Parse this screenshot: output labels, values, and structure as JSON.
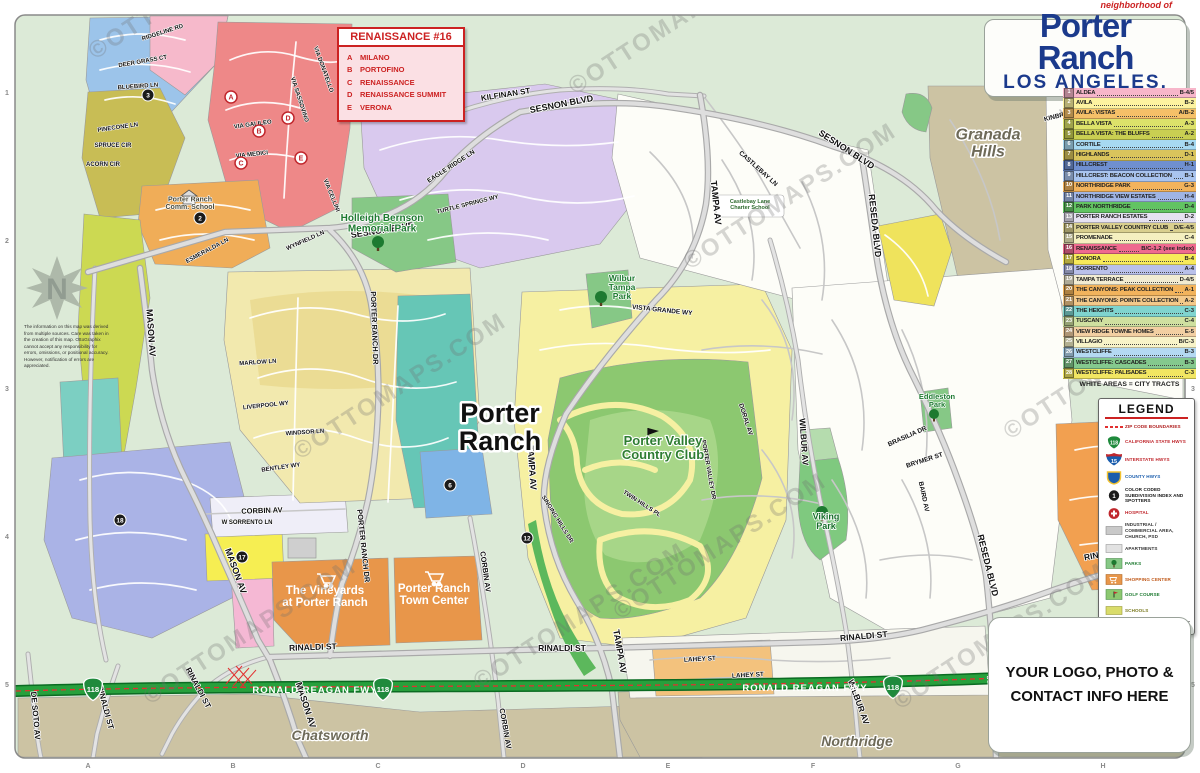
{
  "title_card": {
    "neighborhood_of": "neighborhood of",
    "title": "Porter Ranch",
    "subtitle": "LOS ANGELES, CA"
  },
  "watermark": {
    "text": "©OTTOMAPS.COM"
  },
  "accent_colors": {
    "freeway_green": "#27a03c",
    "zip_red": "#e23030",
    "title_navy": "#1b3a8c"
  },
  "legend_index": {
    "note": "WHITE AREAS = CITY TRACTS",
    "items": [
      {
        "n": "1",
        "name": "ALDEA",
        "ref": "B-4/5",
        "color": "#f7b6ca"
      },
      {
        "n": "2",
        "name": "AVILA",
        "ref": "B-2",
        "color": "#fdf3a0"
      },
      {
        "n": "3",
        "name": "AVILA: VISTAS",
        "ref": "A/B-2",
        "color": "#f5c068"
      },
      {
        "n": "4",
        "name": "BELLA VISTA",
        "ref": "A-3",
        "color": "#dde26a"
      },
      {
        "n": "5",
        "name": "BELLA VISTA: THE BLUFFS",
        "ref": "A-2",
        "color": "#c9cf52"
      },
      {
        "n": "6",
        "name": "CORTILE",
        "ref": "B-4",
        "color": "#a7d9f2"
      },
      {
        "n": "7",
        "name": "HIGHLANDS",
        "ref": "D-1",
        "color": "#d9c45c"
      },
      {
        "n": "8",
        "name": "HILLCREST",
        "ref": "H-1",
        "color": "#6f8fd0"
      },
      {
        "n": "9",
        "name": "HILLCREST: BEACON COLLECTION",
        "ref": "B-1",
        "color": "#a9c4ef"
      },
      {
        "n": "10",
        "name": "NORTHRIDGE PARK",
        "ref": "G-3",
        "color": "#f2b35c"
      },
      {
        "n": "11",
        "name": "NORTHRIDGE VIEW ESTATES",
        "ref": "H-4",
        "color": "#9fb4e4"
      },
      {
        "n": "12",
        "name": "PARK NORTHRIDGE",
        "ref": "D-4",
        "color": "#62c462"
      },
      {
        "n": "13",
        "name": "PORTER RANCH ESTATES",
        "ref": "D-2",
        "color": "#e6e2f2"
      },
      {
        "n": "14",
        "name": "PORTER VALLEY COUNTRY CLUB",
        "ref": "D/E-4/5",
        "color": "#d9cf8e"
      },
      {
        "n": "15",
        "name": "PROMENADE",
        "ref": "C-4",
        "color": "#f5f0c0"
      },
      {
        "n": "16",
        "name": "RENAISSANCE",
        "ref": "B/C-1,2 (see index)",
        "color": "#ef6a8f"
      },
      {
        "n": "17",
        "name": "SONORA",
        "ref": "B-4",
        "color": "#f7ea5a"
      },
      {
        "n": "18",
        "name": "SORRENTO",
        "ref": "A-4",
        "color": "#b9c0ea"
      },
      {
        "n": "19",
        "name": "TAMPA TERRACE",
        "ref": "D-4/5",
        "color": "#f2ecd2"
      },
      {
        "n": "20",
        "name": "THE CANYONS: PEAK COLLECTION",
        "ref": "A-1",
        "color": "#f2b35c"
      },
      {
        "n": "21",
        "name": "THE CANYONS: POINTE COLLECTION",
        "ref": "A-2",
        "color": "#f4c98a"
      },
      {
        "n": "22",
        "name": "THE HEIGHTS",
        "ref": "C-3",
        "color": "#7fd4cf"
      },
      {
        "n": "23",
        "name": "TUSCANY",
        "ref": "C-4",
        "color": "#cfe0a0"
      },
      {
        "n": "24",
        "name": "VIEW RIDGE TOWNE HOMES",
        "ref": "E-5",
        "color": "#f2cfa2"
      },
      {
        "n": "25",
        "name": "VILLAGIO",
        "ref": "B/C-3",
        "color": "#f7f3c8"
      },
      {
        "n": "26",
        "name": "WESTCLIFFE",
        "ref": "B-3",
        "color": "#b4d9f2"
      },
      {
        "n": "27",
        "name": "WESTCLIFFE: CASCADES",
        "ref": "B-3",
        "color": "#84c98e"
      },
      {
        "n": "28",
        "name": "WESTCLIFFE: PALISADES",
        "ref": "C-3",
        "color": "#f2e662"
      }
    ]
  },
  "legend": {
    "title": "LEGEND",
    "spotter_sample": "1",
    "footer": "OttoGraphix Graphic Design & Cartography",
    "items": [
      {
        "icon": "zip-boundary-line-icon",
        "label": "ZIP CODE BOUNDARIES",
        "color": "#b02020"
      },
      {
        "icon": "california-hwy-shield-icon",
        "label": "CALIFORNIA STATE HWYS",
        "color": "#c0272d"
      },
      {
        "icon": "interstate-shield-icon",
        "label": "INTERSTATE HWYS",
        "color": "#c0272d"
      },
      {
        "icon": "county-hwy-shield-icon",
        "label": "COUNTY HWYS",
        "color": "#1a5dad"
      },
      {
        "icon": "subdivision-spotter-icon",
        "label": "COLOR CODED SUBDIVISION INDEX AND SPOTTERS",
        "color": "#111111"
      },
      {
        "icon": "hospital-icon",
        "label": "HOSPITAL",
        "color": "#c0272d"
      },
      {
        "icon": "industrial-swatch-icon",
        "label": "INDUSTRIAL / COMMERCIAL AREA, CHURCH, PSD",
        "color": "#333333"
      },
      {
        "icon": "apartments-swatch-icon",
        "label": "APARTMENTS",
        "color": "#333333"
      },
      {
        "icon": "parks-swatch-icon",
        "label": "PARKS",
        "color": "#1d7a30"
      },
      {
        "icon": "shopping-center-icon",
        "label": "SHOPPING CENTER",
        "color": "#c05818"
      },
      {
        "icon": "golf-course-icon",
        "label": "GOLF COURSE",
        "color": "#1d7a30"
      },
      {
        "icon": "school-swatch-icon",
        "label": "SCHOOLS",
        "color": "#7a7a20"
      }
    ]
  },
  "renaissance_box": {
    "title": "RENAISSANCE #16",
    "entries": [
      {
        "key": "A",
        "name": "MILANO"
      },
      {
        "key": "B",
        "name": "PORTOFINO"
      },
      {
        "key": "C",
        "name": "RENAISSANCE"
      },
      {
        "key": "D",
        "name": "RENAISSANCE SUMMIT"
      },
      {
        "key": "E",
        "name": "VERONA"
      }
    ]
  },
  "contact_box": {
    "text": "YOUR LOGO, PHOTO &\nCONTACT INFO HERE"
  },
  "compass": {
    "label": "N"
  },
  "disclaimer": {
    "text": "The information on this map was derived from multiple sources. Care was taken in the creation of this map. OttoGraphix cannot accept any responsibility for errors, omissions, or positional accuracy. However, notification of errors are appreciated."
  },
  "map": {
    "freeway_label": "RONALD REAGAN FWY",
    "shields": {
      "state": "118",
      "interstate": "15"
    },
    "spotter_letters": [
      "A",
      "B",
      "C",
      "D",
      "E"
    ],
    "spotter_numbers": [
      "2",
      "3",
      "6",
      "12",
      "17",
      "18"
    ],
    "grid_cols": [
      "A",
      "B",
      "C",
      "D",
      "E",
      "F",
      "G",
      "H"
    ],
    "grid_rows": [
      "1",
      "2",
      "3",
      "4",
      "5"
    ],
    "street_labels": [
      "SESNON BLVD",
      "SESNON BLVD",
      "SESNON BLVD",
      "KILFINAN ST",
      "TAMPA AV",
      "TAMPA AV",
      "TAMPA AV",
      "RESEDA BLVD",
      "RESEDA BLVD",
      "RESEDA BLVD",
      "MASON AV",
      "MASON AV",
      "MASON AV",
      "PORTER RANCH DR",
      "PORTER RANCH DR",
      "CORBIN AV",
      "CORBIN AV",
      "CORBIN AV",
      "WILBUR AV",
      "WILBUR AV",
      "RINALDI ST",
      "RINALDI ST",
      "RINALDI ST",
      "RINALDI ST",
      "RINALDI ST",
      "RINALDI ST",
      "DE SOTO AV",
      "EAGLE RIDGE LN",
      "TURTLE SPRINGS WY",
      "CASTLEBAY LN",
      "VISTA GRANDE WY",
      "DORAL AV",
      "BRASILIA DR",
      "BRYMER ST",
      "BAIRD AV",
      "LAHEY ST",
      "LAHEY ST",
      "WYNFIELD LN",
      "ESMERALDA LN",
      "MARLOW LN",
      "LIVERPOOL WY",
      "WINDSOR LN",
      "BENTLEY WY",
      "VIA CELLINI",
      "VIA GALILEO",
      "VIA MEDICI",
      "VIA SASSOVINO",
      "VIA DONATELLO",
      "RIDGELINE RD",
      "DEER GRASS CT",
      "BLUEBIRD LN",
      "PINECONE LN",
      "SPRUCE CIR",
      "ACORN CIR",
      "SINGING HILLS DR",
      "TWIN HILLS PL",
      "PORTER VALLEY DR",
      "W SORRENTO LN",
      "KINBRACE ST"
    ],
    "poi_labels": [
      "Porter\nRanch",
      "Porter Valley\nCountry Club",
      "Holleigh Bernson\nMemorial Park",
      "Wilbur\nTampa\nPark",
      "Viking\nPark",
      "Eddleston\nPark",
      "Porter Ranch\nComm. School",
      "Castlebay Lane\nCharter School",
      "The Vineyards\nat Porter Ranch",
      "Porter Ranch\nTown Center",
      "Granada\nHills",
      "Chatsworth",
      "Northridge"
    ]
  }
}
